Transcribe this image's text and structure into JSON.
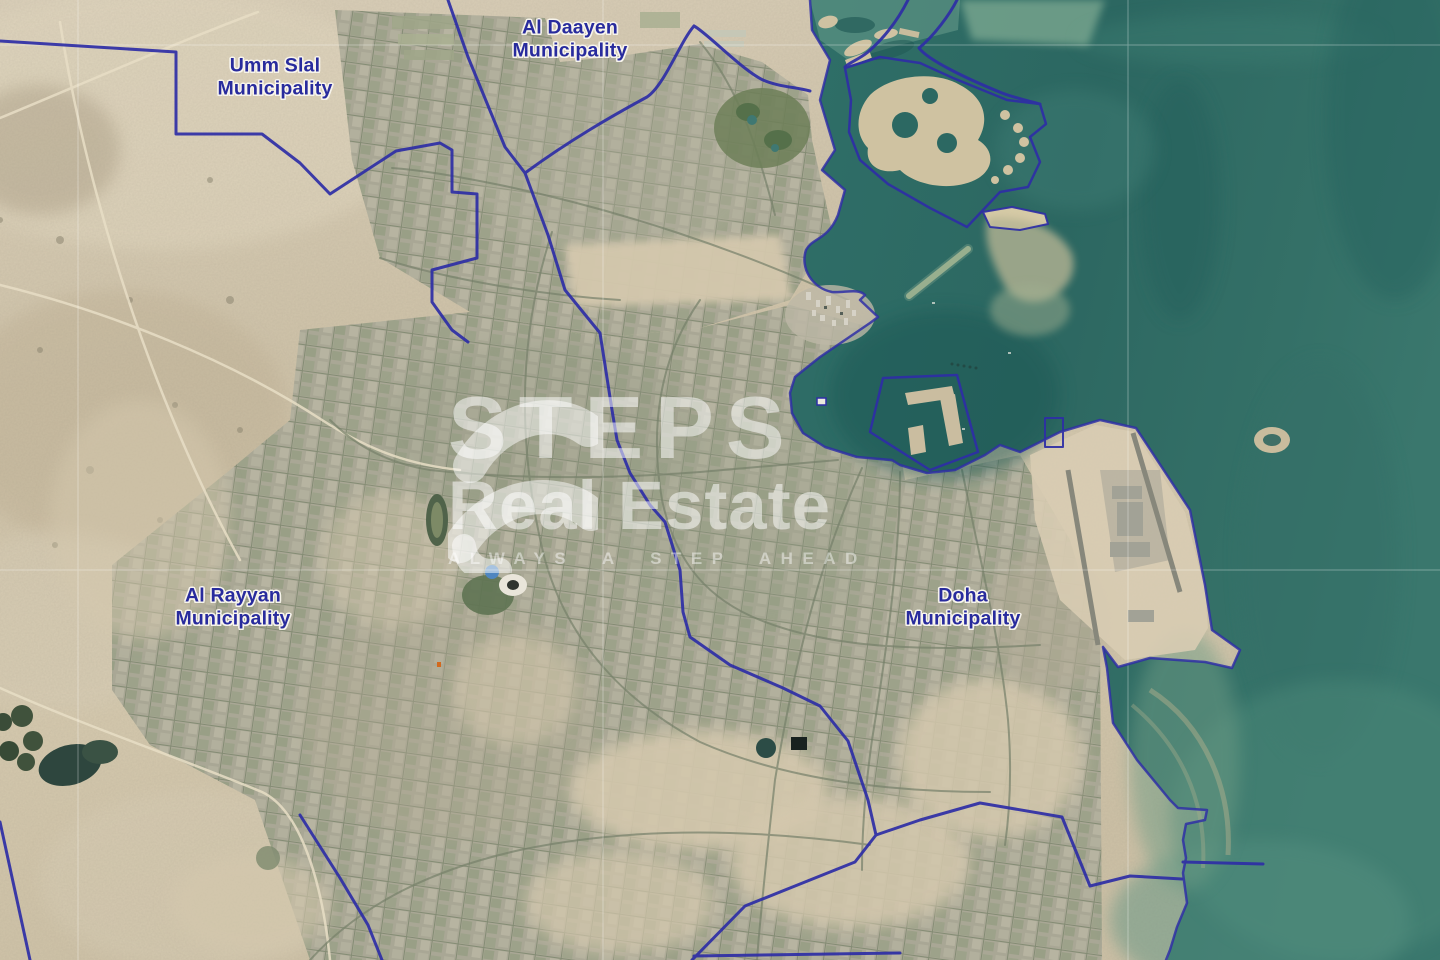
{
  "map": {
    "labels": [
      {
        "id": "umm-slal",
        "line1": "Umm Slal",
        "line2": "Municipality",
        "x": 275,
        "y": 78
      },
      {
        "id": "al-daayen",
        "line1": "Al Daayen",
        "line2": "Municipality",
        "x": 570,
        "y": 40
      },
      {
        "id": "al-rayyan",
        "line1": "Al Rayyan",
        "line2": "Municipality",
        "x": 233,
        "y": 608
      },
      {
        "id": "doha",
        "line1": "Doha",
        "line2": "Municipality",
        "x": 963,
        "y": 608
      }
    ],
    "watermark": {
      "brand_top": "STEPS",
      "brand_bottom": "Real Estate",
      "tagline": "ALWAYS A STEP AHEAD"
    },
    "colors": {
      "boundary_line": "#2e2ea6",
      "label_text": "#282b9d",
      "sea_deep": "#2c6862",
      "sea_shallow": "#6e9c85",
      "desert": "#d2c6ad",
      "urban": "#a9a795",
      "watermark": "rgba(255,255,255,0.52)"
    }
  }
}
